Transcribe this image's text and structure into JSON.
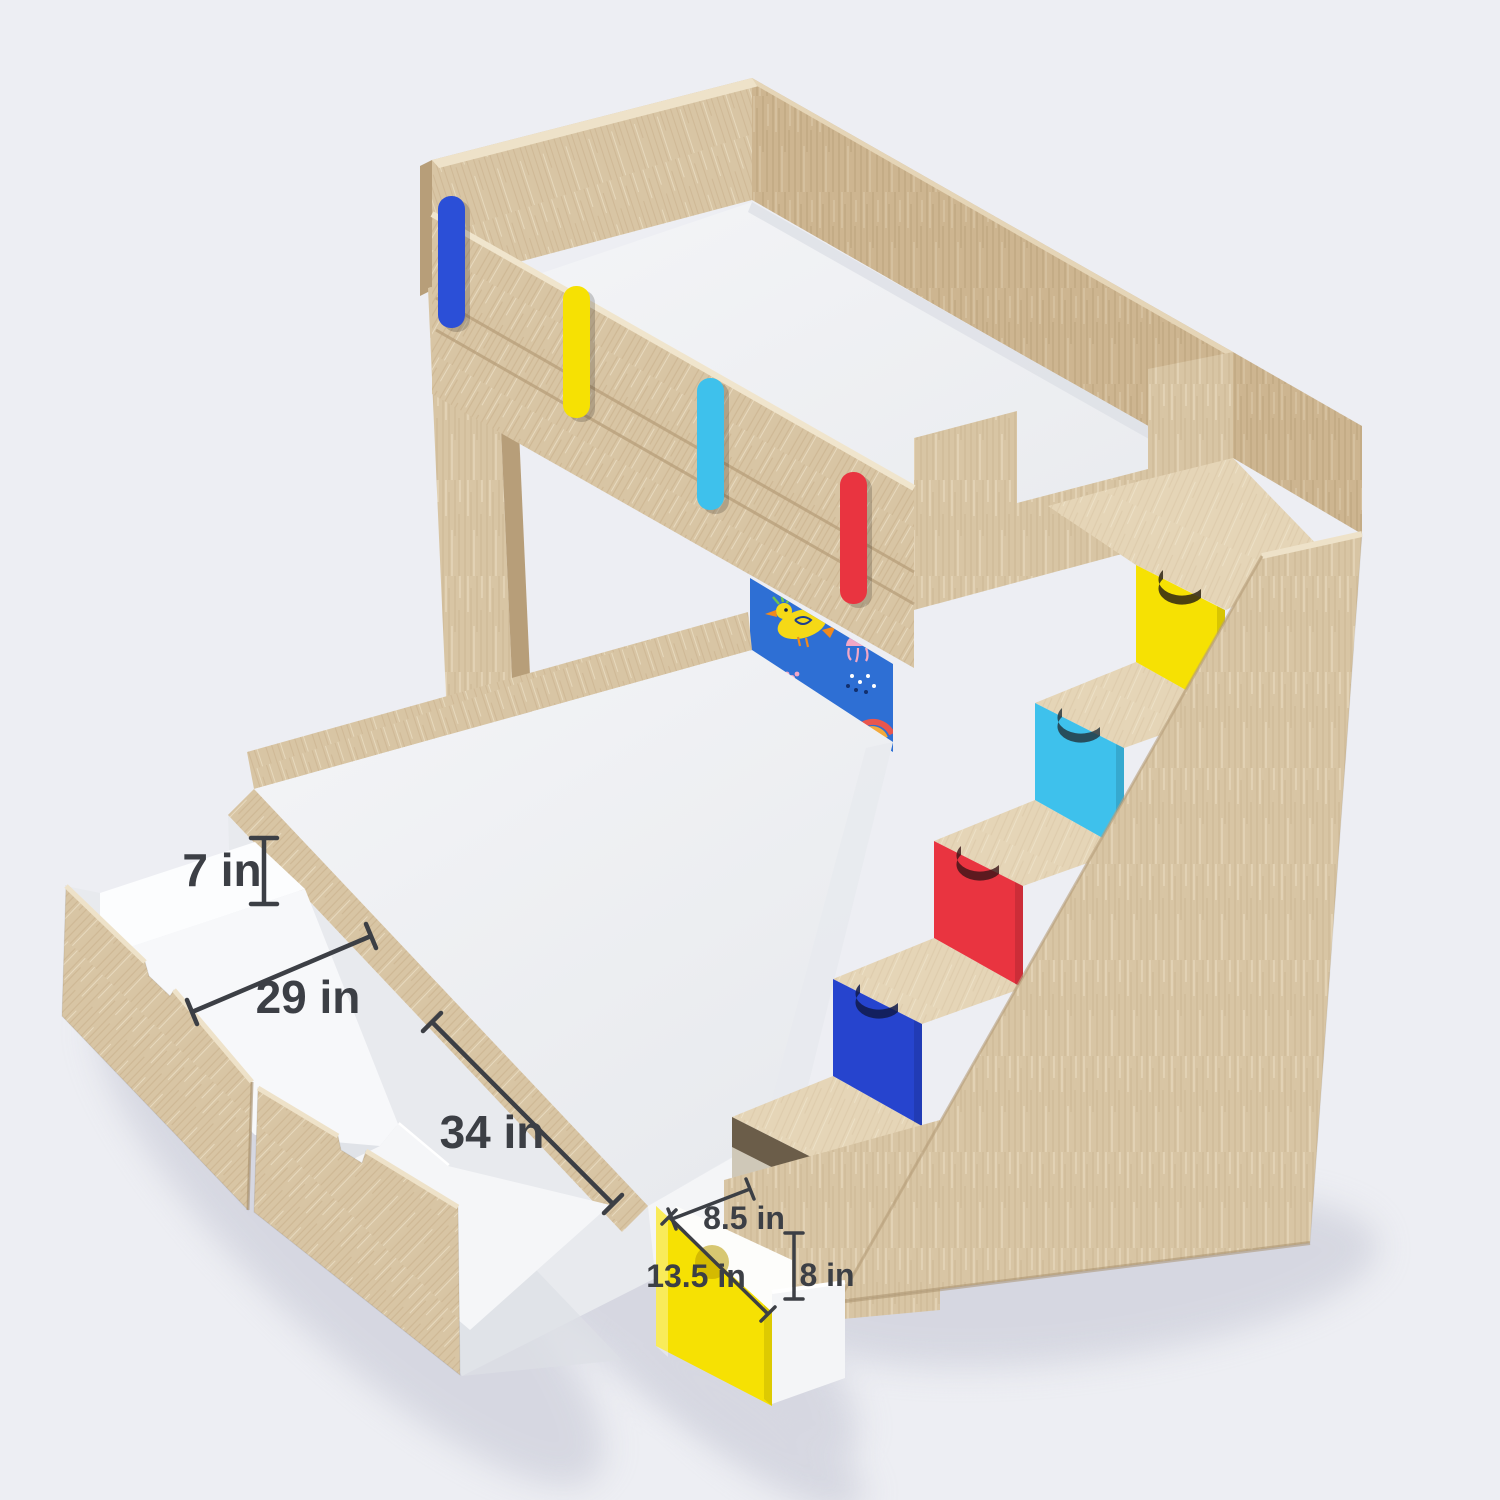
{
  "dims": {
    "underbed_drawer_height": "7 in",
    "underbed_compartment_1_length": "29 in",
    "underbed_compartment_2_length": "34 in",
    "step_drawer_width": "8.5 in",
    "step_drawer_depth": "13.5 in",
    "step_drawer_height": "8 in"
  },
  "palette": {
    "bg": "#edeef3",
    "wood": "#d8c5a4",
    "wood-light": "#e5d5b7",
    "wood-mid": "#cdb590",
    "wood-dark": "#b79e79",
    "wood-deep": "#a68d69",
    "wood-grain": "#c1a883",
    "wood-hi": "#eee2c9",
    "white": "#f4f5f7",
    "white-2": "#e8eaee",
    "white-3": "#dde0e6",
    "white-warm": "#f1efe3",
    "accent-blue": "#2b4fd7",
    "accent-yellow": "#f6e103",
    "accent-cyan": "#3ec1ec",
    "accent-red": "#e93440",
    "accent-royal": "#2644ce",
    "panel-blue": "#2e6fd4",
    "doodle-yellow": "#f5d916",
    "doodle-orange": "#f08a1d",
    "doodle-pink": "#f2a7c6",
    "doodle-green": "#6fc24a",
    "doodle-rainbow-red": "#e8564e",
    "doodle-rainbow-orange": "#f2a93b",
    "dim": "#3c3f45",
    "shadow": "#c7c9d6"
  }
}
